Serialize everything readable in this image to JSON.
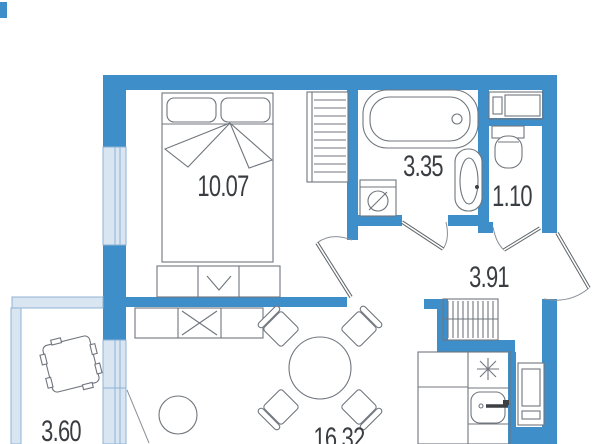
{
  "plan": {
    "title": "apartment-floor-plan",
    "rooms": [
      {
        "id": "bedroom",
        "area": "10.07"
      },
      {
        "id": "bathroom",
        "area": "3.35"
      },
      {
        "id": "wc",
        "area": "1.10"
      },
      {
        "id": "hallway",
        "area": "3.91"
      },
      {
        "id": "living-kitchen",
        "area": "16.32"
      },
      {
        "id": "balcony",
        "area": "3.60"
      }
    ],
    "fixtures": [
      "double-bed",
      "pillows",
      "blanket",
      "wardrobe",
      "dresser",
      "tv-stand",
      "dining-table",
      "chairs",
      "pouf",
      "balcony-armchair",
      "bathtub",
      "washing-machine",
      "bathroom-sink",
      "toilet",
      "water-heater",
      "hall-closet",
      "kitchen-counter",
      "hob",
      "kitchen-sink",
      "refrigerator",
      "entrance-door",
      "bedroom-door",
      "bathroom-door",
      "wc-door",
      "balcony-door",
      "window",
      "balcony-glazing"
    ]
  },
  "colors": {
    "bg": "#ffffff",
    "wall": "#3d8ec9",
    "window_fill": "#d9e6f2",
    "window_line": "#8fb3d4",
    "furniture_line": "#70767d",
    "door_leaf": "#5f6569",
    "door_arc": "#8a9097",
    "label": "#3a3e43"
  }
}
